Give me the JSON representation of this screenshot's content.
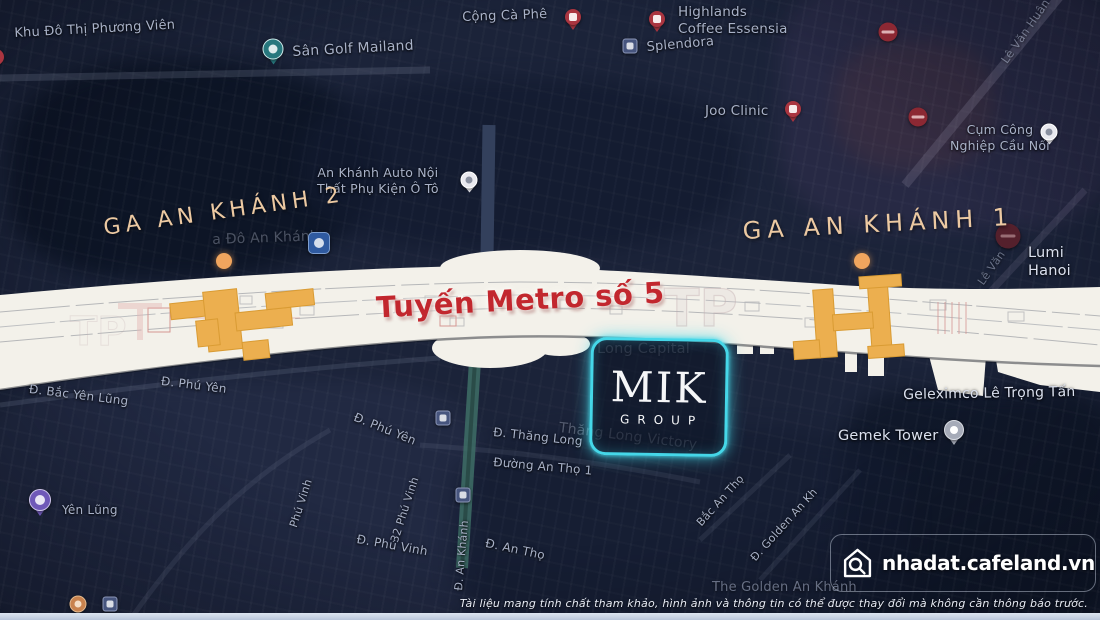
{
  "stations": {
    "station2": {
      "label": "GA AN KHÁNH 2"
    },
    "station1": {
      "label": "GA AN KHÁNH 1"
    }
  },
  "metro_line": {
    "label": "Tuyến Metro số 5"
  },
  "logo": {
    "name": "MIK",
    "subtitle": "GROUP"
  },
  "watermark": {
    "site": "nhadat.cafeland.vn",
    "icon": "home-search-icon"
  },
  "disclaimer": "Tài liệu mang tính chất tham khảo, hình ảnh và thông tin có thể được thay đổi mà không cần thông báo trước.",
  "colors": {
    "background_navy": "#1b2339",
    "band_white": "#f3f1ea",
    "station_orange": "#ecaf4f",
    "metro_red": "#c2272e",
    "station_label_gold": "#ecc9a2",
    "station_dot_orange": "#f0a55e",
    "logo_glow_cyan": "#45d7e8",
    "no_entry_maroon": "#8c2833",
    "map_label_gray": "#a9b2c8",
    "bottom_strip_blue": "#c9d4e4"
  },
  "map_labels": [
    {
      "id": "khu-do-thi-phuong-vien",
      "text": "Khu Đô Thị Phương Viên",
      "x": 14,
      "y": 26,
      "size": 13,
      "rot": -3
    },
    {
      "id": "san-golf-mailand",
      "text": "Sân Golf Mailand",
      "x": 292,
      "y": 44,
      "size": 14,
      "rot": -3
    },
    {
      "id": "cong-ca-phe",
      "text": "Cộng Cà Phê",
      "x": 462,
      "y": 10,
      "size": 13,
      "rot": -2
    },
    {
      "id": "highlands-coffee-essensia",
      "text": "Highlands\nCoffee Essensia",
      "x": 678,
      "y": 4,
      "size": 13.5,
      "rot": 0
    },
    {
      "id": "splendora",
      "text": "Splendora",
      "x": 646,
      "y": 40,
      "size": 13,
      "rot": -5
    },
    {
      "id": "joo-clinic",
      "text": "Joo Clinic",
      "x": 705,
      "y": 103,
      "size": 13.5,
      "rot": 0
    },
    {
      "id": "cum-cong-nghiep-cau-noi",
      "text": "Cụm Công\nNghiệp Cầu Nối",
      "x": 950,
      "y": 122,
      "size": 12.5,
      "rot": 0,
      "cls": "center"
    },
    {
      "id": "le-van-huan",
      "text": "Lê Văn Huân",
      "x": 998,
      "y": 58,
      "size": 11.5,
      "rot": -55,
      "cls": "dim"
    },
    {
      "id": "lumi-hanoi",
      "text": "Lumi Hanoi",
      "x": 1028,
      "y": 244,
      "size": 14.5,
      "rot": 0,
      "cls": "bright"
    },
    {
      "id": "le-van-tan",
      "text": "Lê Văn Tấn",
      "x": 975,
      "y": 280,
      "size": 11,
      "rot": -55,
      "cls": "dim"
    },
    {
      "id": "an-khanh-auto",
      "text": "An Khánh Auto Nội\nThất Phụ Kiện Ô Tô",
      "x": 317,
      "y": 165,
      "size": 12.5,
      "rot": 0,
      "cls": "center"
    },
    {
      "id": "gemek-tower",
      "text": "Gemek Tower",
      "x": 838,
      "y": 427,
      "size": 14.5,
      "rot": 0,
      "cls": "bright"
    },
    {
      "id": "geleximco-le-trong-tan",
      "text": "Geleximco Lê Trọng Tấn",
      "x": 903,
      "y": 387,
      "size": 14,
      "rot": -1,
      "cls": "bright"
    },
    {
      "id": "the-golden-an-khanh",
      "text": "The Golden An Khánh",
      "x": 712,
      "y": 580,
      "size": 13,
      "rot": 0,
      "cls": "dim"
    },
    {
      "id": "d-bac-yen-lung",
      "text": "Đ. Bắc Yên Lũng",
      "x": 30,
      "y": 382,
      "size": 12,
      "rot": 7
    },
    {
      "id": "yen-lung",
      "text": "Yên Lũng",
      "x": 62,
      "y": 503,
      "size": 12,
      "rot": 0
    },
    {
      "id": "d-phu-yen-1",
      "text": "Đ. Phú Yên",
      "x": 162,
      "y": 374,
      "size": 12,
      "rot": 7
    },
    {
      "id": "d-phu-yen-2",
      "text": "Đ. Phú Yên",
      "x": 357,
      "y": 410,
      "size": 12,
      "rot": 22
    },
    {
      "id": "phu-vinh",
      "text": "Phú Vinh",
      "x": 287,
      "y": 525,
      "size": 11,
      "rot": -72
    },
    {
      "id": "32-phu-vinh",
      "text": "32 Phú Vinh",
      "x": 388,
      "y": 540,
      "size": 11,
      "rot": -72
    },
    {
      "id": "d-phu-vinh",
      "text": "Đ. Phú Vinh",
      "x": 358,
      "y": 532,
      "size": 12,
      "rot": 10
    },
    {
      "id": "d-an-khanh",
      "text": "Đ. An Khánh",
      "x": 452,
      "y": 590,
      "size": 11,
      "rot": -85
    },
    {
      "id": "d-an-tho",
      "text": "Đ. An Thọ",
      "x": 487,
      "y": 536,
      "size": 12,
      "rot": 12
    },
    {
      "id": "d-thang-long",
      "text": "Đ. Thăng Long",
      "x": 494,
      "y": 425,
      "size": 12,
      "rot": 6
    },
    {
      "id": "duong-an-tho-1",
      "text": "Đường An Thọ 1",
      "x": 494,
      "y": 455,
      "size": 12,
      "rot": 5
    },
    {
      "id": "bac-an-tho",
      "text": "Bắc An Thọ",
      "x": 694,
      "y": 520,
      "size": 11,
      "rot": -48
    },
    {
      "id": "d-golden-an-khanh",
      "text": "Đ. Golden An Kh",
      "x": 748,
      "y": 555,
      "size": 11,
      "rot": -48
    },
    {
      "id": "long-capital",
      "text": "Long Capital",
      "x": 597,
      "y": 340,
      "size": 14.5,
      "rot": 0,
      "cls": "faint"
    },
    {
      "id": "thang-long-victory",
      "text": "Thăng Long Victory",
      "x": 560,
      "y": 420,
      "size": 14,
      "rot": 7,
      "cls": "faint"
    },
    {
      "id": "an-khanh-faint",
      "text": "a Đô An Khánh",
      "x": 212,
      "y": 232,
      "size": 14,
      "rot": -2,
      "cls": "faint"
    }
  ],
  "pins": [
    {
      "id": "pin-cong-ca-phe",
      "type": "pin-round-red",
      "x": 573,
      "y": 17
    },
    {
      "id": "pin-highlands",
      "type": "pin-round-red",
      "x": 657,
      "y": 19
    },
    {
      "id": "pin-left-edge",
      "type": "pin-round-red",
      "x": -4,
      "y": 57
    },
    {
      "id": "pin-joo-clinic",
      "type": "pin-round-red",
      "x": 793,
      "y": 109
    },
    {
      "id": "icon-splendora-stop",
      "type": "pin-square",
      "x": 630,
      "y": 46
    },
    {
      "id": "icon-stop-1",
      "type": "pin-square",
      "x": 443,
      "y": 418
    },
    {
      "id": "icon-stop-2",
      "type": "pin-square",
      "x": 463,
      "y": 495
    },
    {
      "id": "icon-stop-3",
      "type": "pin-square",
      "x": 110,
      "y": 604
    },
    {
      "id": "no-entry-1",
      "type": "pin-no-entry",
      "x": 888,
      "y": 32
    },
    {
      "id": "no-entry-2",
      "type": "pin-no-entry",
      "x": 918,
      "y": 117
    },
    {
      "id": "no-entry-3",
      "type": "pin-no-entry-dark",
      "x": 1008,
      "y": 236
    },
    {
      "id": "pin-cau-noi",
      "type": "pin-white",
      "x": 1049,
      "y": 132
    },
    {
      "id": "pin-an-khanh-auto",
      "type": "pin-white",
      "x": 469,
      "y": 180
    },
    {
      "id": "pin-san-golf",
      "type": "pin-teal",
      "x": 273,
      "y": 49
    },
    {
      "id": "pin-an-khanh-shield",
      "type": "pin-shield",
      "x": 319,
      "y": 243
    },
    {
      "id": "pin-gemek-tower",
      "type": "pin-grey",
      "x": 954,
      "y": 430
    },
    {
      "id": "pin-yen-lung",
      "type": "pin-purple",
      "x": 40,
      "y": 500
    },
    {
      "id": "pin-orange-bottom",
      "type": "pin-orange",
      "x": 78,
      "y": 604
    }
  ]
}
